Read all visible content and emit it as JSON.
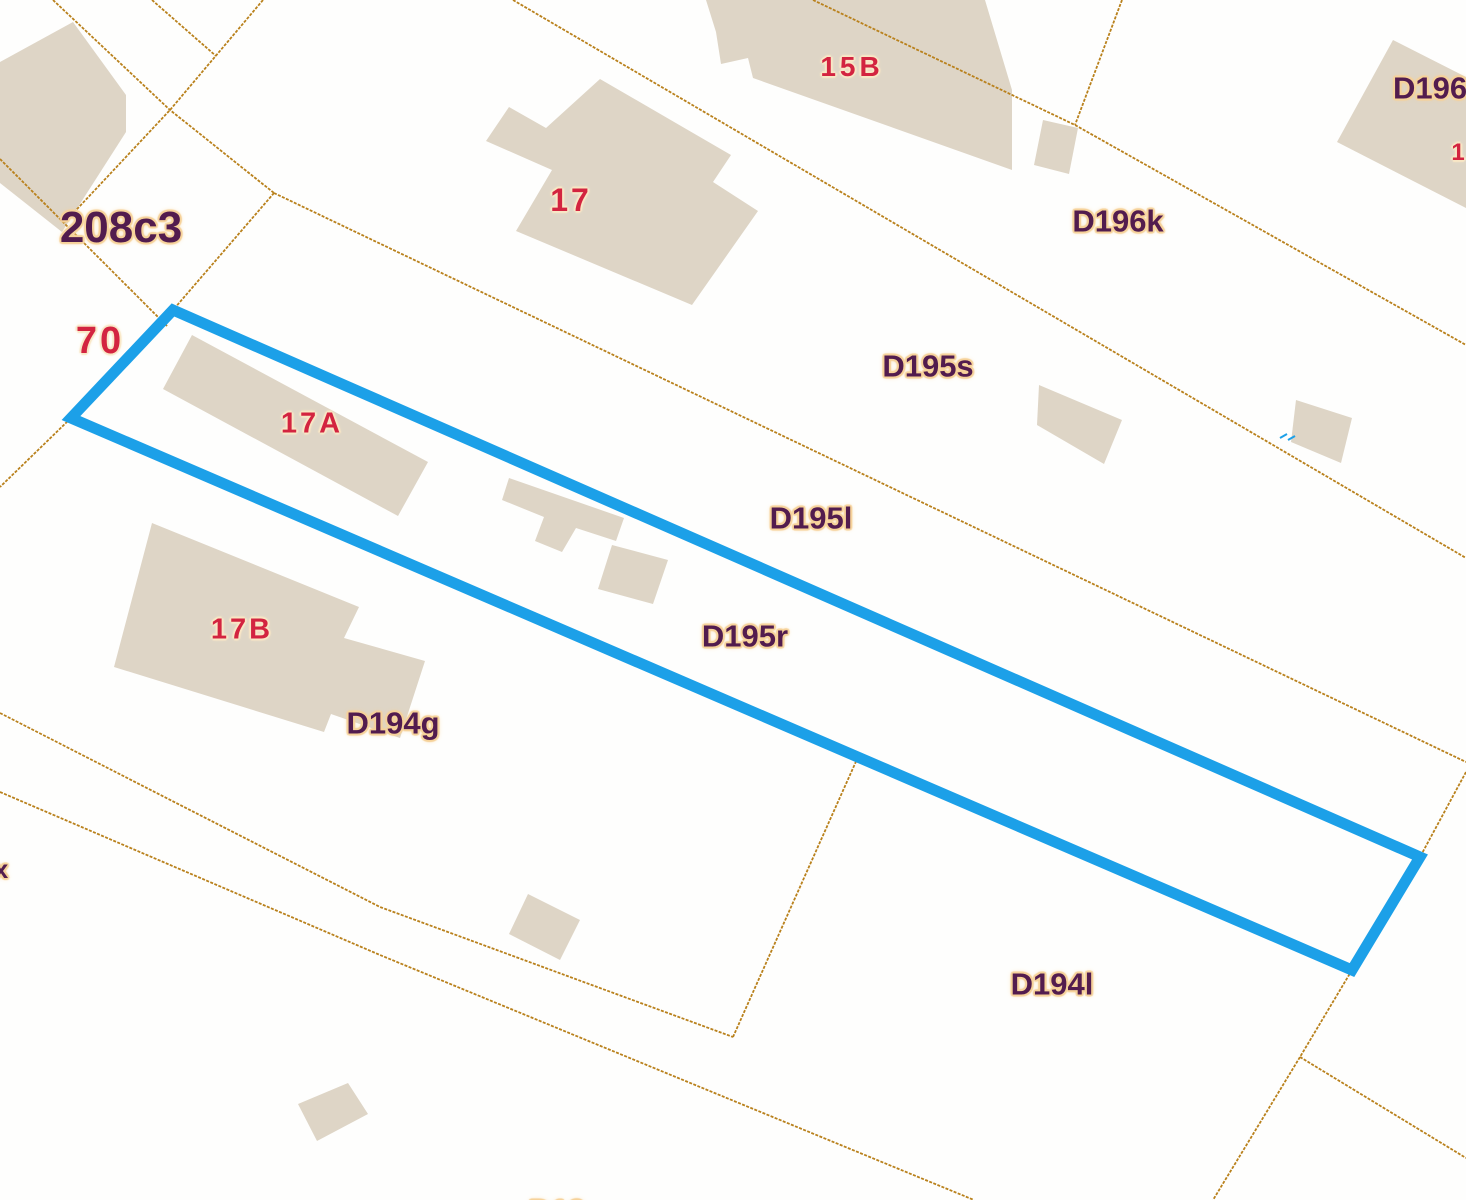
{
  "map": {
    "type": "cadastral-parcel-map",
    "highlighted_parcel": "D195r",
    "colors": {
      "background": "#fefefd",
      "building_fill": "#ded5c6",
      "boundary_line": "#b9811c",
      "highlight_outline": "#1ca0e8",
      "parcel_label_text": "#521c4e",
      "parcel_label_halo": "#f6d29a",
      "house_number_text": "#d32440",
      "house_number_halo": "#f9e7c6"
    },
    "labels": [
      {
        "text": "208c3",
        "kind": "parcel"
      },
      {
        "text": "70",
        "kind": "house"
      },
      {
        "text": "17",
        "kind": "house"
      },
      {
        "text": "15B",
        "kind": "house"
      },
      {
        "text": "D196",
        "kind": "parcel",
        "clipped": "right-edge"
      },
      {
        "text": "1",
        "kind": "house",
        "clipped": "right-edge"
      },
      {
        "text": "D196k",
        "kind": "parcel"
      },
      {
        "text": "D195s",
        "kind": "parcel"
      },
      {
        "text": "17A",
        "kind": "house"
      },
      {
        "text": "D195l",
        "kind": "parcel"
      },
      {
        "text": "D195r",
        "kind": "parcel"
      },
      {
        "text": "17B",
        "kind": "house"
      },
      {
        "text": "D194g",
        "kind": "parcel"
      },
      {
        "text": "D194l",
        "kind": "parcel"
      },
      {
        "text": "x",
        "kind": "parcel",
        "clipped": "left-edge"
      },
      {
        "text": "D19",
        "kind": "parcel",
        "clipped": "bottom-edge"
      }
    ]
  }
}
